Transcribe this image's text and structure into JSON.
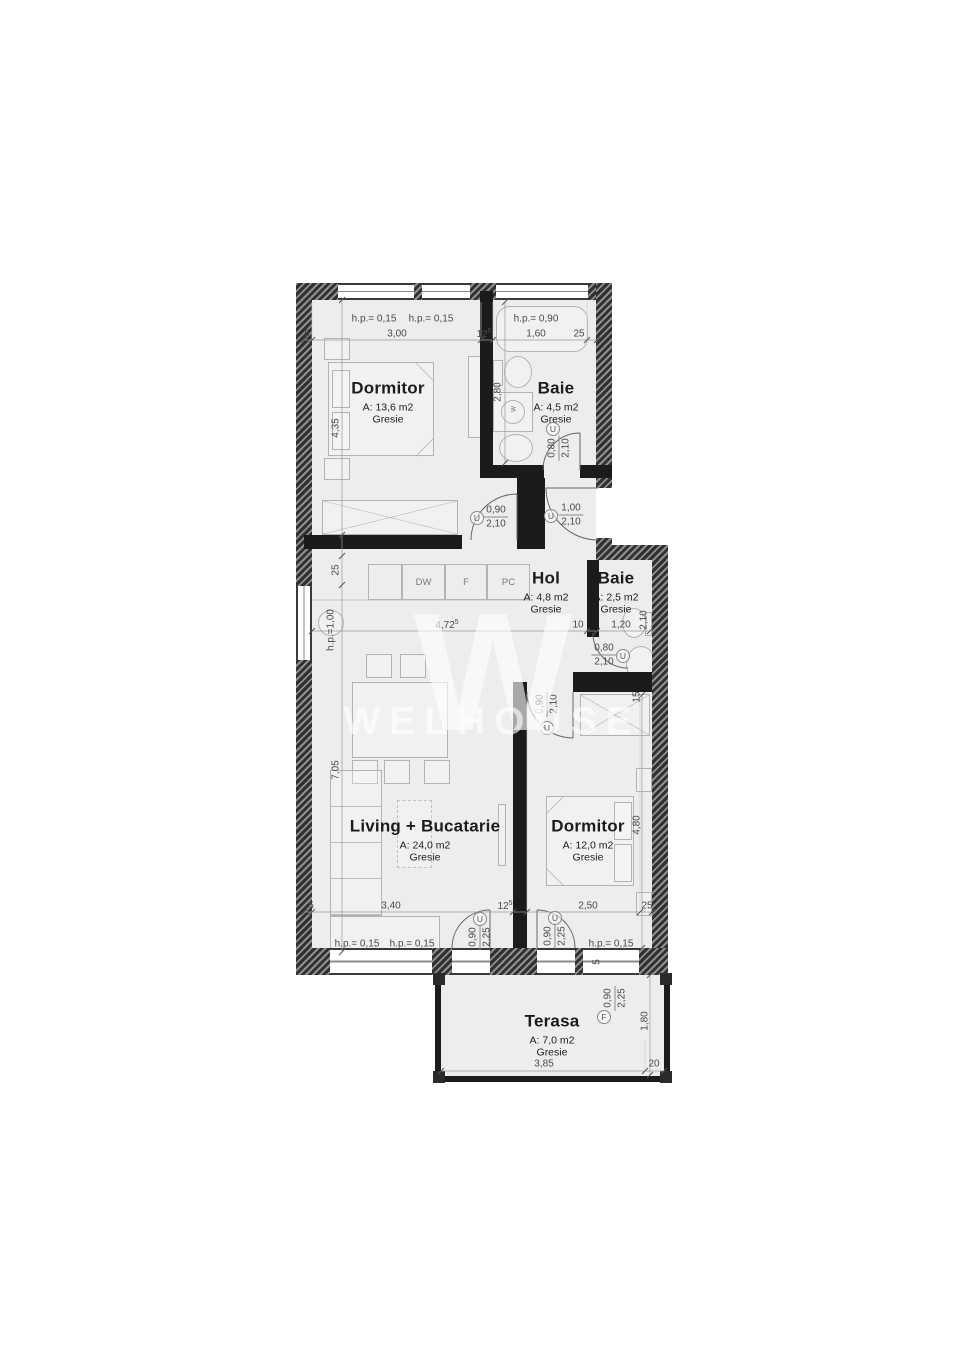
{
  "watermark": {
    "logo": "W",
    "name": "WELHOUSE"
  },
  "rooms": {
    "dormitor1": {
      "name": "Dormitor",
      "area": "A: 13,6 m2",
      "floor": "Gresie"
    },
    "baie1": {
      "name": "Baie",
      "area": "A: 4,5 m2",
      "floor": "Gresie"
    },
    "hol": {
      "name": "Hol",
      "area": "A: 4,8 m2",
      "floor": "Gresie"
    },
    "baie2": {
      "name": "Baie",
      "area": "A: 2,5 m2",
      "floor": "Gresie"
    },
    "living": {
      "name": "Living + Bucatarie",
      "area": "A: 24,0 m2",
      "floor": "Gresie"
    },
    "dormitor2": {
      "name": "Dormitor",
      "area": "A: 12,0 m2",
      "floor": "Gresie"
    },
    "terasa": {
      "name": "Terasa",
      "area": "A: 7,0 m2",
      "floor": "Gresie"
    }
  },
  "kitchen": {
    "dw": "DW",
    "f": "F",
    "pc": "PC",
    "washer": "w"
  },
  "dims": {
    "hp015": "h.p.= 0,15",
    "hp090": "h.p.= 0,90",
    "hp100": "h.p.=1,00",
    "n5": "5",
    "n10": "10",
    "n15": "15",
    "n20": "20",
    "n25": "25",
    "n300": "3,00",
    "n125": "12",
    "sup5": "5",
    "n160": "1,60",
    "n435": "4,35",
    "n280": "2,80",
    "n705": "7,05",
    "n480": "4,80",
    "n180": "1,80",
    "n472": "4,72",
    "n120": "1,20",
    "n210": "2,10",
    "n340": "3,40",
    "n250": "2,50",
    "n385": "3,85"
  },
  "doors": {
    "u": "U",
    "f": "F",
    "w080": "0,80",
    "w090": "0,90",
    "w100": "1,00",
    "h210": "2,10",
    "h225": "2,25"
  }
}
